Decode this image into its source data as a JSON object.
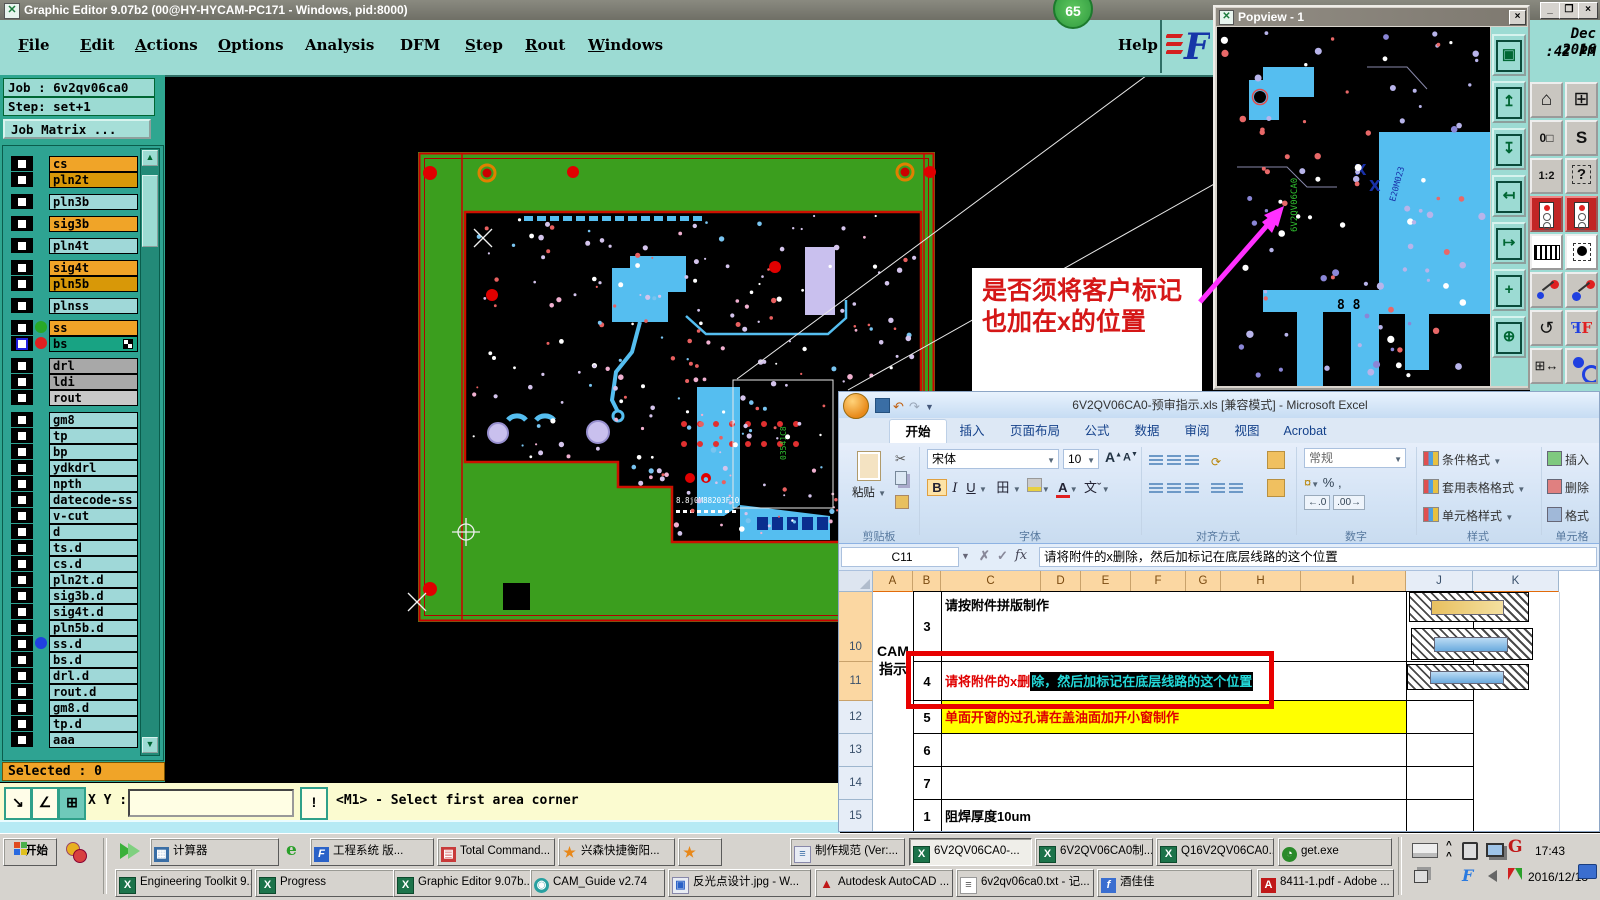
{
  "colors": {
    "teal": "#9cdbd3",
    "teal_dark": "#2fa690",
    "board_green": "#3b9e1e",
    "trace_cyan": "#55bef0",
    "pad_lavender": "#c9c0ee",
    "alert_red": "#e80000",
    "sel_orange": "#f0a428",
    "yellow": "#ffff00"
  },
  "ge": {
    "title": "Graphic Editor 9.07b2 (00@HY-HYCAM-PC171 - Windows, pid:8000)",
    "badge": "65",
    "menu": [
      {
        "label": "File",
        "u": 0
      },
      {
        "label": "Edit",
        "u": 0
      },
      {
        "label": "Actions",
        "u": 0
      },
      {
        "label": "Options",
        "u": 0
      },
      {
        "label": "Analysis",
        "u": -1
      },
      {
        "label": "DFM",
        "u": -1
      },
      {
        "label": "Step",
        "u": 0
      },
      {
        "label": "Rout",
        "u": 0
      },
      {
        "label": "Windows",
        "u": 0
      }
    ],
    "help": "Help",
    "job_label": "Job : 6v2qv06ca0",
    "step_label": "Step: set+1",
    "job_matrix": "Job Matrix ...",
    "selected": "Selected : 0",
    "xy_label": "X Y :",
    "excl": "!",
    "status": "<M1> - Select first area corner",
    "clock1": "Dec 2016",
    "clock2": ":42 PM",
    "board_text": "8.8j0M88203F10",
    "board_text_green": "03541C8",
    "layers": [
      {
        "name": "cs",
        "bg": "#f0a428"
      },
      {
        "name": "pln2t",
        "bg": "#d89808"
      },
      {
        "name": "pln3b",
        "bg": "#9fd8d8",
        "gap": true
      },
      {
        "name": "sig3b",
        "bg": "#f0a428",
        "gap": true
      },
      {
        "name": "pln4t",
        "bg": "#9fd8d8",
        "gap": true
      },
      {
        "name": "sig4t",
        "bg": "#f0a428",
        "gap": true
      },
      {
        "name": "pln5b",
        "bg": "#d89808"
      },
      {
        "name": "plnss",
        "bg": "#9fd8d8",
        "gap": true
      },
      {
        "name": "ss",
        "bg": "#f0a428",
        "gap": true,
        "dot": "#28a828"
      },
      {
        "name": "bs",
        "bg": "#18a383",
        "dot": "#e02020",
        "cb": "#2020e0",
        "grid": true
      },
      {
        "name": "drl",
        "bg": "#a8a8a8",
        "gap": true
      },
      {
        "name": "ldi",
        "bg": "#a8a8a8"
      },
      {
        "name": "rout",
        "bg": "#c8c8c8"
      },
      {
        "name": "gm8",
        "bg": "#9fd8d8",
        "gap": true
      },
      {
        "name": "tp",
        "bg": "#9fd8d8"
      },
      {
        "name": "bp",
        "bg": "#9fd8d8"
      },
      {
        "name": "ydkdrl",
        "bg": "#9fd8d8"
      },
      {
        "name": "npth",
        "bg": "#9fd8d8"
      },
      {
        "name": "datecode-ss",
        "bg": "#9fd8d8"
      },
      {
        "name": "v-cut",
        "bg": "#9fd8d8"
      },
      {
        "name": "d",
        "bg": "#9fd8d8"
      },
      {
        "name": "ts.d",
        "bg": "#9fd8d8"
      },
      {
        "name": "cs.d",
        "bg": "#9fd8d8"
      },
      {
        "name": "pln2t.d",
        "bg": "#9fd8d8"
      },
      {
        "name": "sig3b.d",
        "bg": "#9fd8d8"
      },
      {
        "name": "sig4t.d",
        "bg": "#9fd8d8"
      },
      {
        "name": "pln5b.d",
        "bg": "#9fd8d8"
      },
      {
        "name": "ss.d",
        "bg": "#9fd8d8",
        "dot": "#2040e0"
      },
      {
        "name": "bs.d",
        "bg": "#9fd8d8"
      },
      {
        "name": "drl.d",
        "bg": "#9fd8d8"
      },
      {
        "name": "rout.d",
        "bg": "#9fd8d8"
      },
      {
        "name": "gm8.d",
        "bg": "#9fd8d8"
      },
      {
        "name": "tp.d",
        "bg": "#9fd8d8"
      },
      {
        "name": "aaa",
        "bg": "#9fd8d8"
      }
    ]
  },
  "annotation": {
    "line1": "是否须将客户标记",
    "line2": "也加在x的位置"
  },
  "popview": {
    "title": "Popview - 1",
    "green_text": "6V2QV06CA0",
    "navy_text": "E20M023",
    "eights": "8  8"
  },
  "excel": {
    "title": "6V2QV06CA0-预审指示.xls [兼容模式] - Microsoft Excel",
    "tabs": [
      "开始",
      "插入",
      "页面布局",
      "公式",
      "数据",
      "审阅",
      "视图",
      "Acrobat"
    ],
    "ribbon": {
      "paste": "粘贴",
      "font_name": "宋体",
      "font_size": "10",
      "number_format": "常规",
      "styles": [
        "条件格式",
        "套用表格格式",
        "单元格样式"
      ],
      "cells": [
        "插入",
        "删除",
        "格式"
      ],
      "groups": [
        "剪贴板",
        "字体",
        "对齐方式",
        "数字",
        "样式",
        "单元格"
      ],
      "glyphs": {
        "bold": "B",
        "italic": "I",
        "underline": "U",
        "border": "田",
        "phonetic": "文",
        "scissors": "✂",
        "percent": "%",
        "comma": ",",
        "coin": "¤",
        "dec0": ".0",
        "dec00": ".00",
        "fontup": "A",
        "fontdn": "A"
      }
    },
    "name_box": "C11",
    "fx": "fx",
    "formula": "请将附件的x删除，然后加标记在底层线路的这个位置",
    "columns": [
      "A",
      "B",
      "C",
      "D",
      "E",
      "F",
      "G",
      "H",
      "I",
      "J",
      "K"
    ],
    "side_label1": "CAM",
    "side_label2": "指示",
    "rows": [
      {
        "num": "10",
        "b": "3",
        "c": "请按附件拼版制作"
      },
      {
        "num": "11",
        "b": "4",
        "c_pre": "请将附件的x删",
        "c_sel": "除，然后加标记在底层线路的这个位置"
      },
      {
        "num": "12",
        "b": "5",
        "c": "单面开窗的过孔请在盖油面加开小窗制作",
        "yellow": true
      },
      {
        "num": "13",
        "b": "6",
        "c": ""
      },
      {
        "num": "14",
        "b": "7",
        "c": ""
      },
      {
        "num": "15",
        "b": "1",
        "c": "阻焊厚度10um"
      }
    ]
  },
  "taskbar": {
    "start": "开始",
    "row1": [
      {
        "icon": "calc",
        "label": "计算器"
      },
      {
        "icon": "fblue",
        "label": "工程系统 版..."
      },
      {
        "icon": "floppy",
        "label": "Total Command..."
      },
      {
        "icon": "star",
        "label": "兴森快捷衡阳..."
      },
      {
        "icon": "star",
        "label": ""
      },
      {
        "icon": "doc",
        "label": "制作规范 (Ver:..."
      },
      {
        "icon": "excel",
        "label": "6V2QV06CA0-...",
        "active": true
      },
      {
        "icon": "excel",
        "label": "6V2QV06CA0制..."
      },
      {
        "icon": "excel",
        "label": "Q16V2QV06CA0..."
      },
      {
        "icon": "getexe",
        "label": "get.exe"
      }
    ],
    "row2": [
      {
        "icon": "excel",
        "label": "Engineering Toolkit 9..."
      },
      {
        "icon": "excel",
        "label": "Progress"
      },
      {
        "icon": "excel",
        "label": "Graphic Editor 9.07b..."
      },
      {
        "icon": "cam",
        "label": "CAM_Guide v2.74"
      },
      {
        "icon": "img",
        "label": "反光点设计.jpg - W..."
      },
      {
        "icon": "acad",
        "label": "Autodesk AutoCAD ..."
      },
      {
        "icon": "txt",
        "label": "6v2qv06ca0.txt - 记..."
      },
      {
        "icon": "feiq",
        "label": "酒佳佳"
      },
      {
        "icon": "pdf",
        "label": "8411-1.pdf - Adobe ..."
      }
    ],
    "tray": {
      "time": "17:43",
      "date": "2016/12/13"
    }
  }
}
